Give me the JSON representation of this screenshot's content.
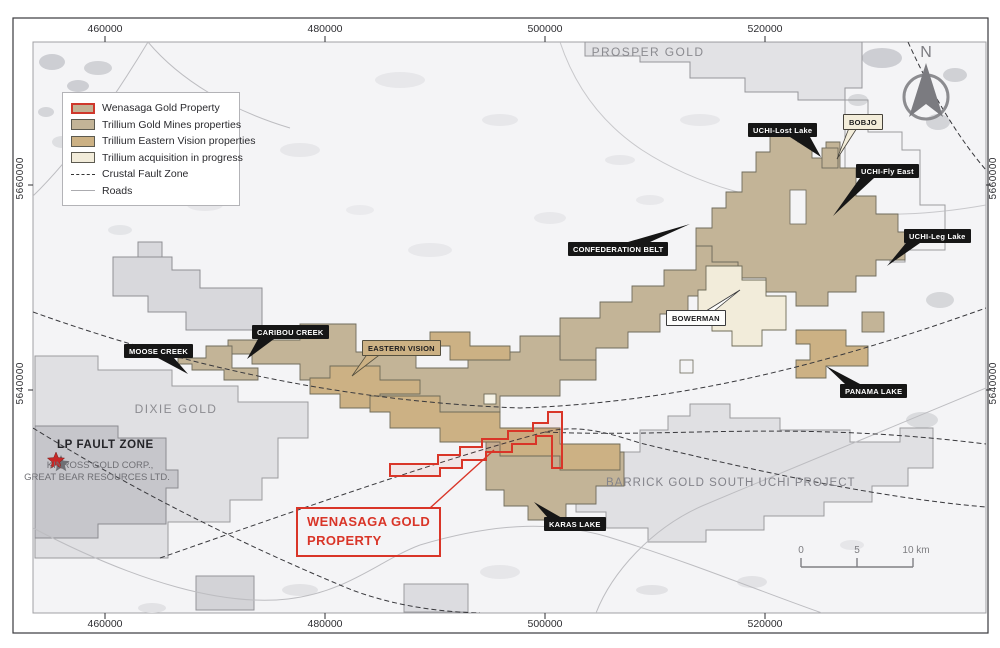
{
  "axes": {
    "x_ticks": [
      "460000",
      "480000",
      "500000",
      "520000"
    ],
    "y_ticks": [
      "5660000",
      "5640000"
    ]
  },
  "north": {
    "label": "N"
  },
  "scalebar": {
    "tick0": "0",
    "tick1": "5",
    "tick2": "10 km"
  },
  "legend": {
    "items": [
      {
        "label": "Wenasaga Gold Property"
      },
      {
        "label": "Trillium Gold Mines properties"
      },
      {
        "label": "Trillium Eastern Vision properties"
      },
      {
        "label": "Trillium acquisition in progress"
      },
      {
        "label": "Crustal Fault Zone"
      },
      {
        "label": "Roads"
      }
    ]
  },
  "callouts": {
    "uchi_lost_lake": "UCHI-Lost Lake",
    "bobjo": "BOBJO",
    "uchi_fly_east": "UCHI-Fly East",
    "uchi_leg_lake": "UCHI-Leg Lake",
    "confederation_belt": "CONFEDERATION BELT",
    "bowerman": "BOWERMAN",
    "caribou_creek": "CARIBOU CREEK",
    "moose_creek": "MOOSE CREEK",
    "eastern_vision": "EASTERN VISION",
    "panama_lake": "PANAMA LAKE",
    "karas_lake": "KARAS LAKE"
  },
  "area_labels": {
    "prosper_gold": "PROSPER GOLD",
    "dixie_gold": "DIXIE GOLD",
    "barrick": "BARRICK GOLD SOUTH UCHI PROJECT",
    "lp_fault_zone": "LP FAULT ZONE",
    "kinross": "KINROSS GOLD CORP.,",
    "great_bear": "GREAT BEAR RESOURCES LTD."
  },
  "property_callout": {
    "line1": "WENASAGA GOLD",
    "line2": "PROPERTY"
  },
  "colors": {
    "wenasaga_red": "#d93528",
    "gold_mines_tan": "#c3b497",
    "eastern_vision_tan": "#ccb184",
    "acquisition_cream": "#f2ecda",
    "callout_black": "#161616"
  }
}
